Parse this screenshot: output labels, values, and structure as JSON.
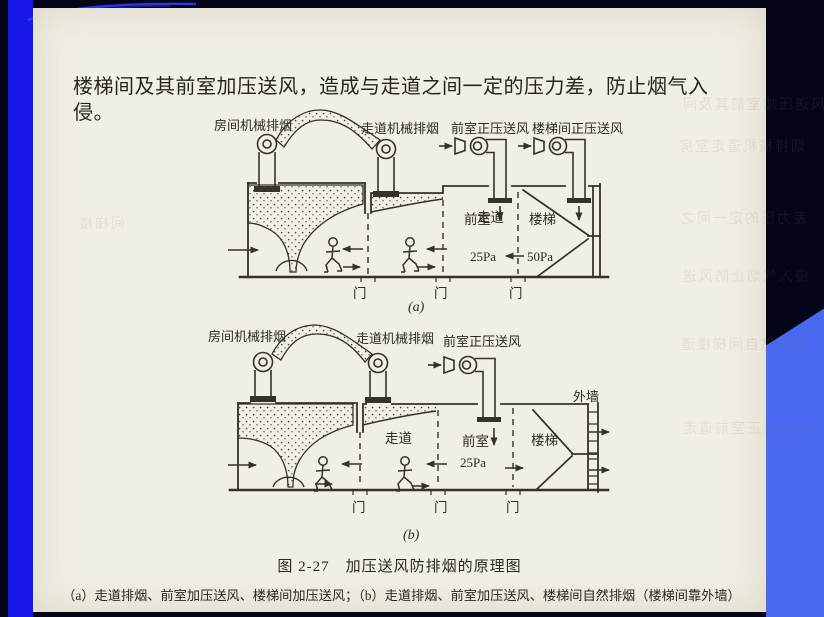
{
  "colors": {
    "left_bar_blue": "#1718e8",
    "corner_blue": "#4868f0",
    "background_navy": "#05051a",
    "page_cream": "#f1eee4",
    "ink": "#2e2b26"
  },
  "page": {
    "intro_text": "楼梯间及其前室加压送风，造成与走道之间一定的压力差，防止烟气入侵。",
    "caption_title": "图 2-27　加压送风防排烟的原理图",
    "caption_sub": "（a）走道排烟、前室加压送风、楼梯间加压送风；（b）走道排烟、前室加压送风、楼梯间自然排烟（楼梯间靠外墙）",
    "ghost": [
      "风送压加室前其及间",
      "烟排械机道走室房",
      "差力压的定一间之",
      "侵入气烟止防风送",
      "烟排然自间梯楼道",
      "风送压正室前道走",
      "间梯楼"
    ]
  },
  "diagram_a": {
    "tag": "(a)",
    "labels": {
      "room_fan": "房间机械排烟",
      "corridor_fan": "走道机械排烟",
      "lobby_fan": "前室正压送风",
      "stair_fan": "楼梯间正压送风"
    },
    "rooms": {
      "corridor": "走道",
      "lobby": "前室",
      "stair": "楼梯"
    },
    "pressure": {
      "lobby": "25Pa",
      "stair": "50Pa"
    },
    "door": "门"
  },
  "diagram_b": {
    "tag": "(b)",
    "labels": {
      "room_fan": "房间机械排烟",
      "corridor_fan": "走道机械排烟",
      "lobby_fan": "前室正压送风",
      "outer_wall": "外墙"
    },
    "rooms": {
      "corridor": "走道",
      "lobby": "前室",
      "stair": "楼梯"
    },
    "pressure": {
      "lobby": "25Pa"
    },
    "door": "门"
  }
}
